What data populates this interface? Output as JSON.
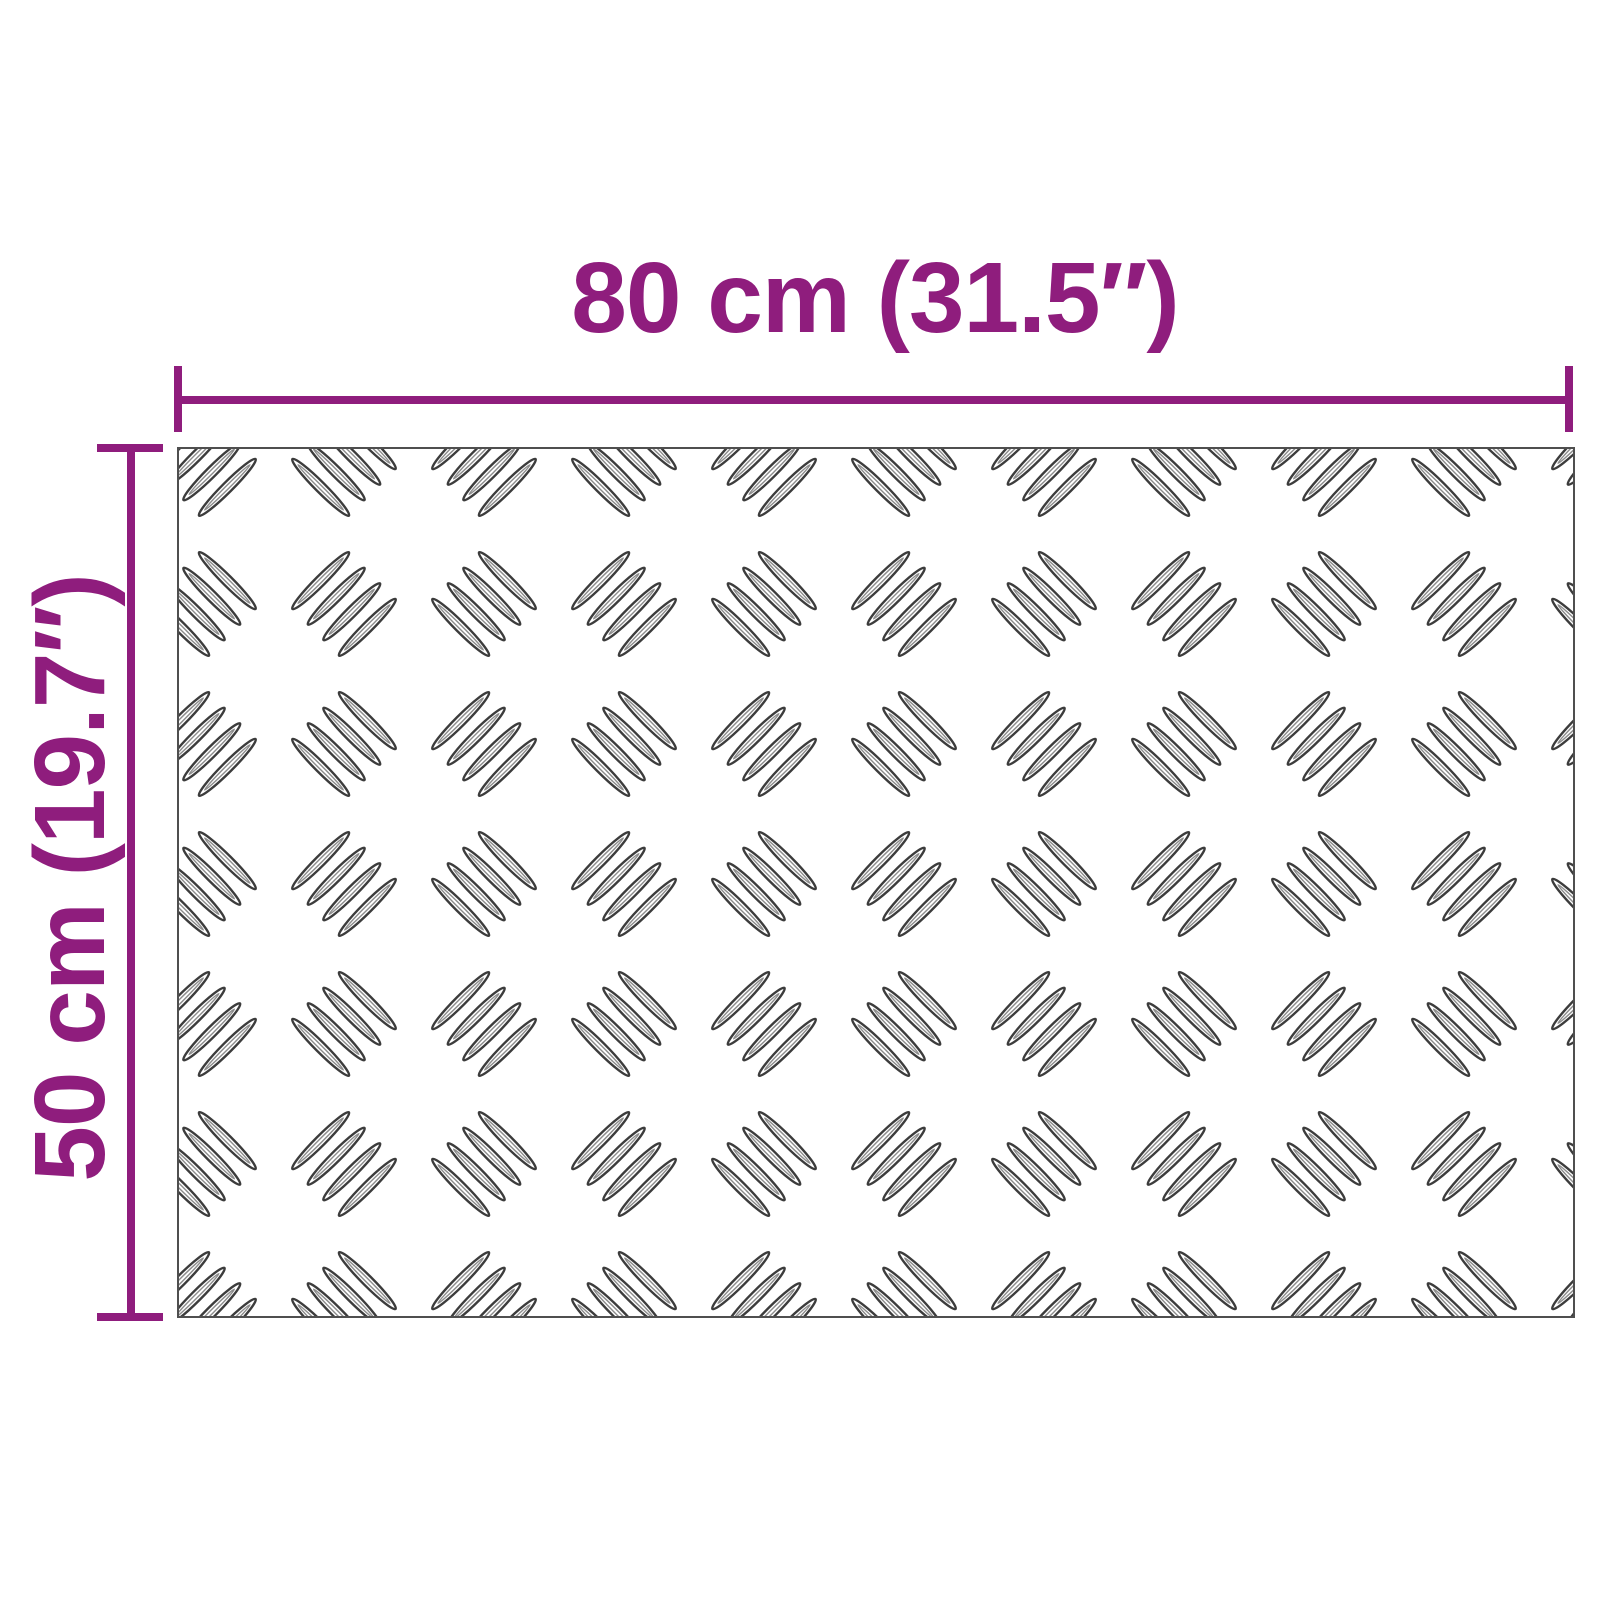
{
  "diagram": {
    "type": "product-dimension-diagram",
    "subject": "aluminium checker plate sheet",
    "width_label": "80 cm (31.5″)",
    "height_label": "50 cm (19.7″)",
    "pattern": "checker-plate-5bar",
    "colors": {
      "accent": "#8F1D7D",
      "plate_border": "#4f4f4f",
      "pattern_stroke": "#3c3c3c",
      "pattern_inner": "#8c8c8c",
      "background": "#ffffff"
    }
  }
}
